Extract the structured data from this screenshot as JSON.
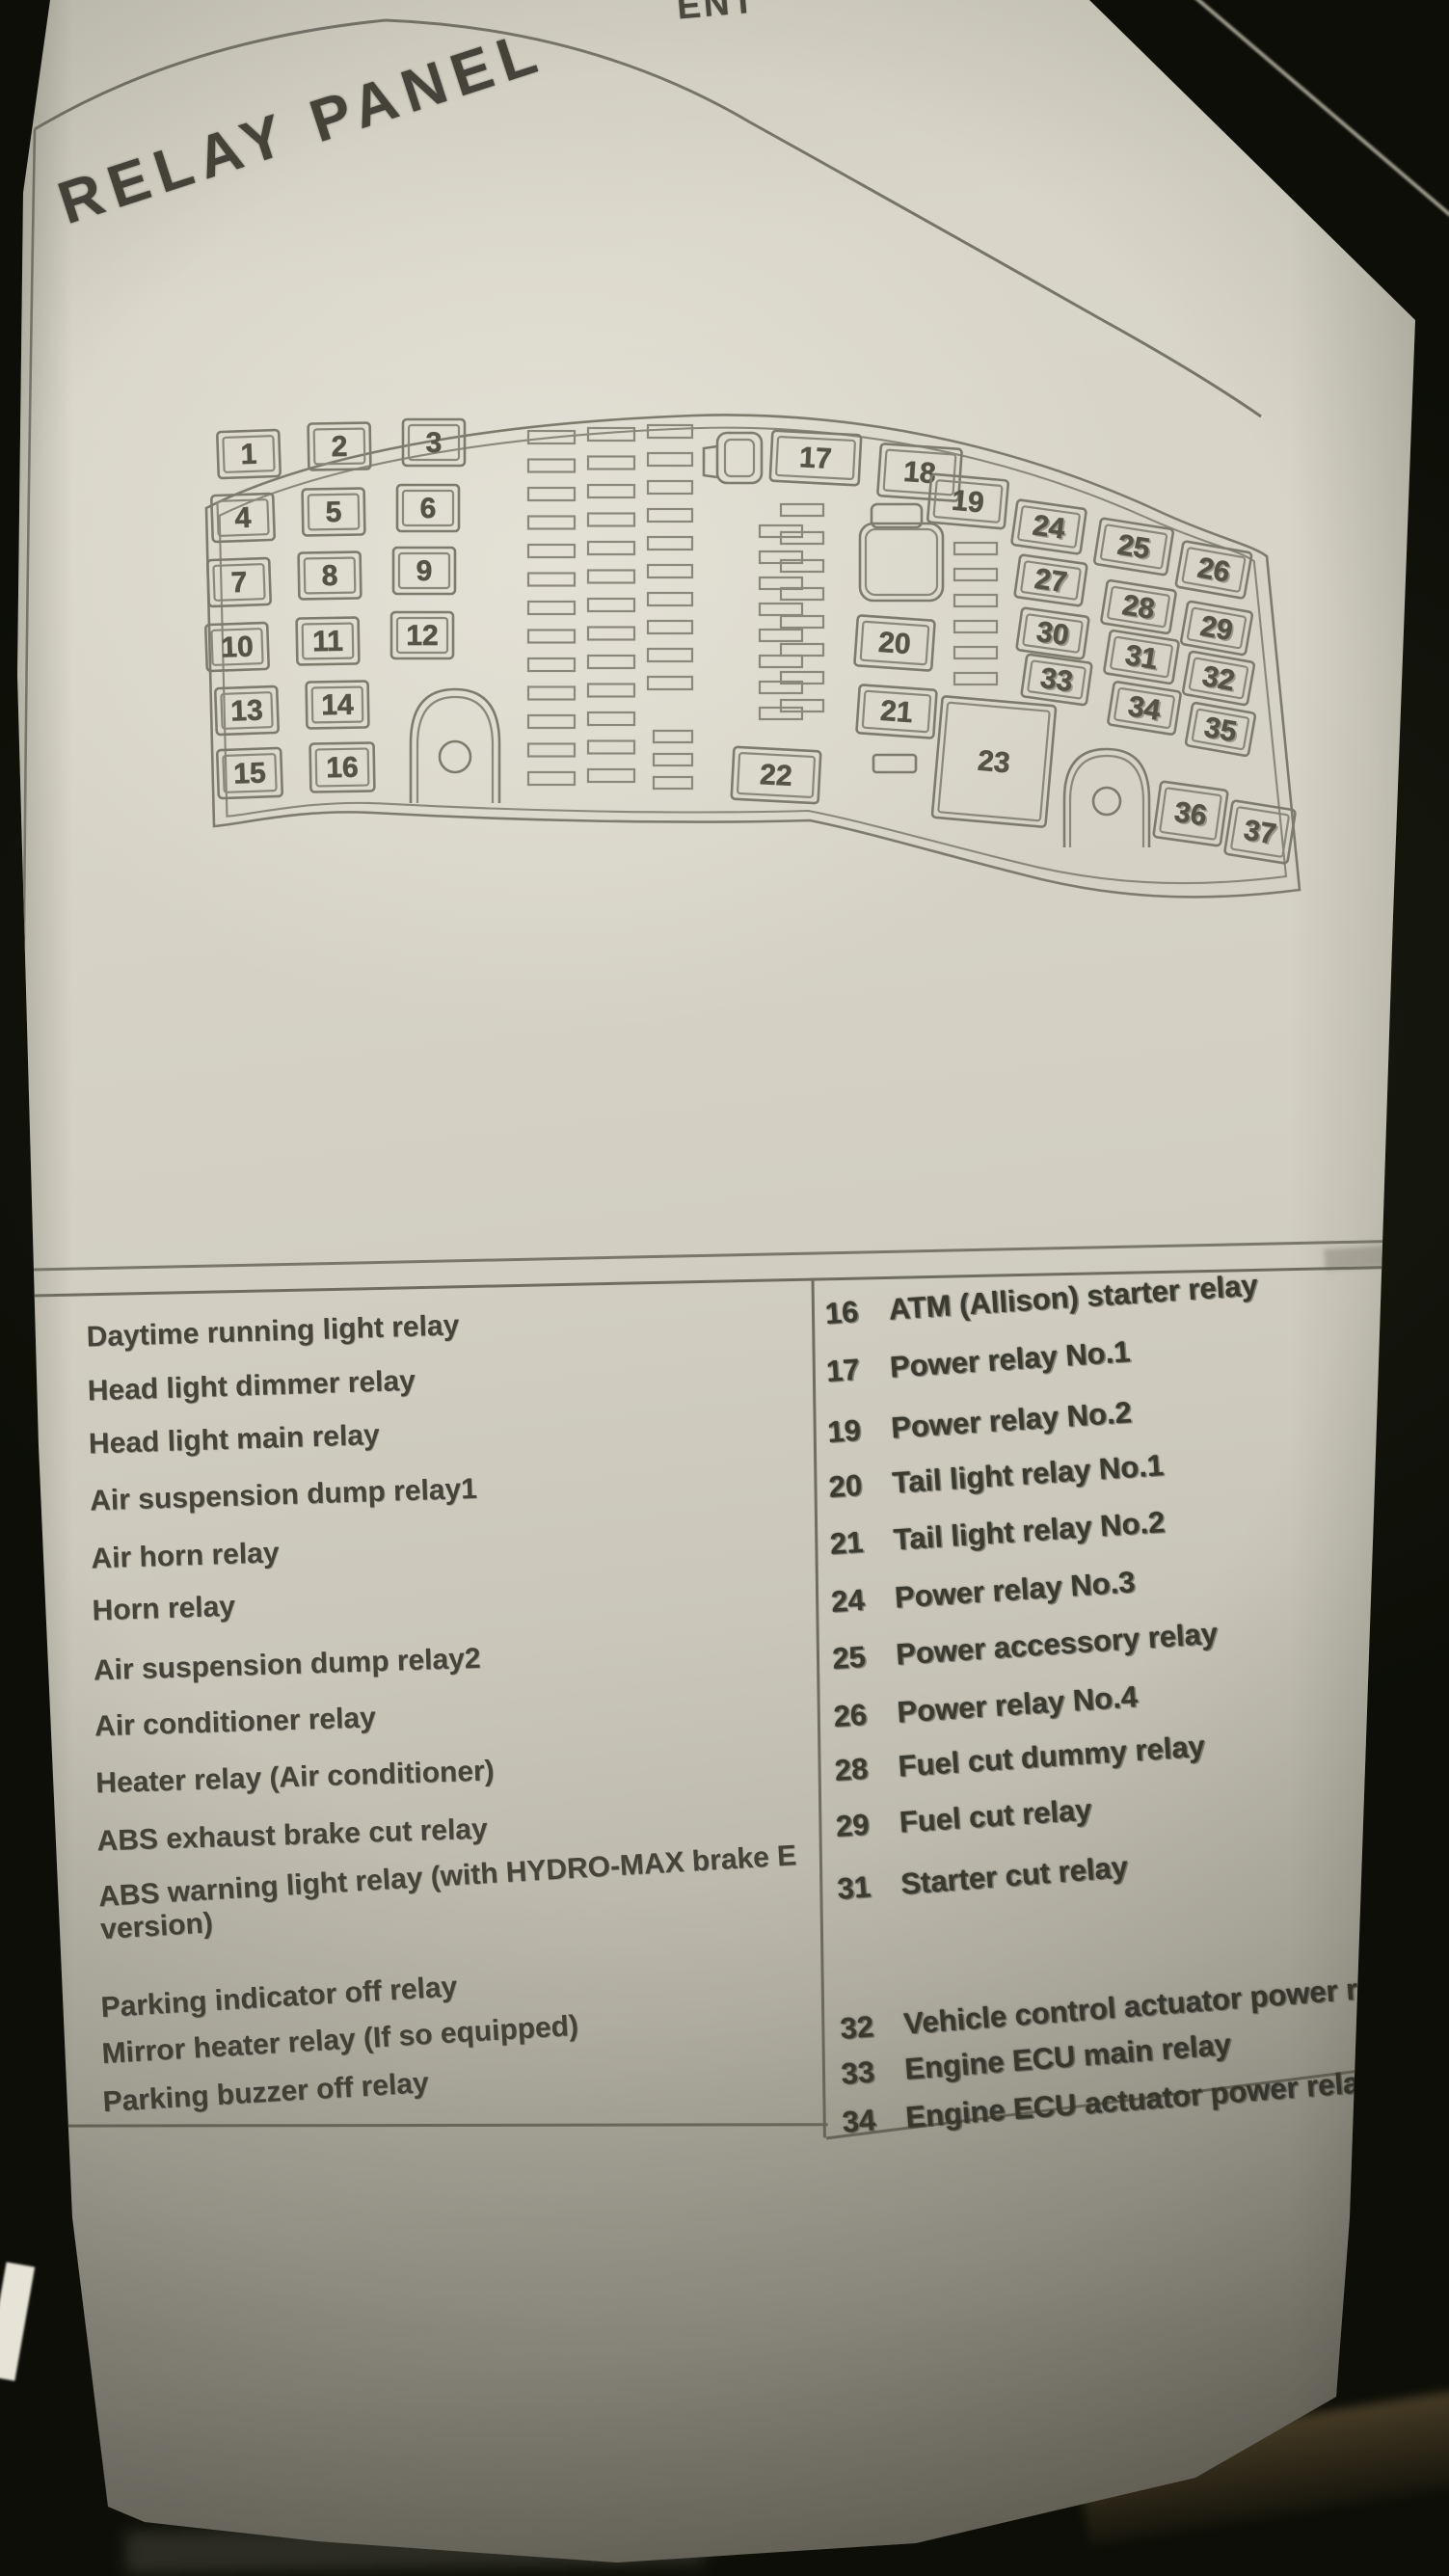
{
  "page": {
    "title": "RELAY PANEL",
    "top_edge_cropped_text": "ENT",
    "corner_page_code": "E04-6"
  },
  "diagram": {
    "left_grid": [
      [
        "1",
        "2",
        "3"
      ],
      [
        "4",
        "5",
        "6"
      ],
      [
        "7",
        "8",
        "9"
      ],
      [
        "10",
        "11",
        "12"
      ],
      [
        "13",
        "14"
      ],
      [
        "15",
        "16"
      ]
    ],
    "top_row": [
      "17",
      "18",
      "19"
    ],
    "middle_column": [
      "20",
      "21",
      "22",
      "23"
    ],
    "right_grid": [
      [
        "24",
        "25",
        "26"
      ],
      [
        "27",
        "28",
        "29"
      ],
      [
        "30",
        "31",
        "32"
      ],
      [
        "33",
        "34",
        "35"
      ]
    ],
    "bottom_row": [
      "36",
      "37"
    ]
  },
  "legend": {
    "left_column": [
      {
        "no": "1",
        "label": "Daytime running light relay"
      },
      {
        "no": "2",
        "label": "Head light dimmer relay"
      },
      {
        "no": "3",
        "label": "Head light main relay"
      },
      {
        "no": "4",
        "label": "Air suspension dump relay1"
      },
      {
        "no": "5",
        "label": "Air horn relay"
      },
      {
        "no": "6",
        "label": "Horn relay"
      },
      {
        "no": "7",
        "label": "Air suspension dump relay2"
      },
      {
        "no": "8",
        "label": "Air conditioner relay"
      },
      {
        "no": "9",
        "label": "Heater relay (Air conditioner)"
      },
      {
        "no": "10",
        "label": "ABS exhaust brake cut relay"
      },
      {
        "no": "11",
        "label": "ABS warning light relay  (with HYDRO-MAX brake E version)"
      },
      {
        "no": "13",
        "label": "Parking indicator off relay"
      },
      {
        "no": "14",
        "label": "Mirror heater relay (If so equipped)"
      },
      {
        "no": "15",
        "label": "Parking buzzer off relay"
      }
    ],
    "right_column": [
      {
        "no": "16",
        "label": "ATM (Allison) starter relay"
      },
      {
        "no": "17",
        "label": "Power relay No.1"
      },
      {
        "no": "19",
        "label": "Power relay No.2"
      },
      {
        "no": "20",
        "label": "Tail light relay No.1"
      },
      {
        "no": "21",
        "label": "Tail light relay No.2"
      },
      {
        "no": "24",
        "label": "Power relay No.3"
      },
      {
        "no": "25",
        "label": "Power accessory relay"
      },
      {
        "no": "26",
        "label": "Power relay No.4"
      },
      {
        "no": "28",
        "label": "Fuel cut dummy relay"
      },
      {
        "no": "29",
        "label": "Fuel cut relay"
      },
      {
        "no": "31",
        "label": "Starter cut relay"
      },
      {
        "no": "32",
        "label": "Vehicle control actuator power relay"
      },
      {
        "no": "33",
        "label": "Engine ECU main relay"
      },
      {
        "no": "34",
        "label": "Engine ECU actuator power relay"
      }
    ]
  }
}
